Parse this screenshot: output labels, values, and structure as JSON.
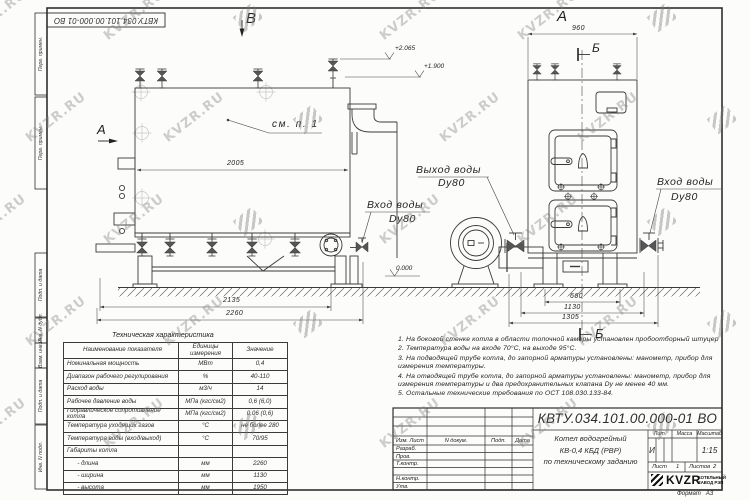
{
  "watermark": {
    "text": "KVZR.RU"
  },
  "frame": {
    "top_stamp": "КВТУ.034.101.00.000-01 ВО",
    "left_columns": [
      "Перв. примен.",
      "Перв. примен.",
      "Подп. и дата",
      "Инв. N дубл.",
      "Взам. инв. N",
      "Подп. и дата",
      "Инв. N подл."
    ],
    "format_note": "Формат   А3"
  },
  "drawing": {
    "view_b_label": "В",
    "view_a_arrow_label": "А",
    "view_a_title": "А",
    "section_b_top": "Б",
    "section_b_bottom": "Б",
    "see_note": "см. п. 1",
    "levels": {
      "top": "+2.065",
      "mid": "+1.900",
      "zero": "0.000"
    },
    "labels": {
      "outlet_title": "Выход воды",
      "outlet_size": "Dy80",
      "inlet_side_title": "Вход воды",
      "inlet_side_size": "Dy80",
      "inlet_front_title": "Вход воды",
      "inlet_front_size": "Dy80"
    },
    "dims_side": [
      "2005",
      "2135",
      "2260"
    ],
    "dims_front": [
      "960",
      "660",
      "1130",
      "1305"
    ]
  },
  "spec_table": {
    "title": "Техническая характеристика",
    "headers": [
      "Наименование показателя",
      "Единицы измерения",
      "Значение"
    ],
    "rows": [
      {
        "name": "Номинальная мощность",
        "unit": "МВт",
        "value": "0,4"
      },
      {
        "name": "Диапазон рабочего регулирования",
        "unit": "%",
        "value": "40-110"
      },
      {
        "name": "Расход воды",
        "unit": "м3/ч",
        "value": "14"
      },
      {
        "name": "Рабочее давление воды",
        "unit": "МПа (кгс/см2)",
        "value": "0,6 (6,0)"
      },
      {
        "name": "Гидравлическое сопротивление котла",
        "unit": "МПа (кгс/см2)",
        "value": "0,06 (0,6)"
      },
      {
        "name": "Температура уходящих газов",
        "unit": "°С",
        "value": "не более 280"
      },
      {
        "name": "Температура воды (вход/выход)",
        "unit": "°С",
        "value": "70/95"
      },
      {
        "name": "Габариты котла",
        "unit": "",
        "value": ""
      },
      {
        "name": "      - длина",
        "unit": "мм",
        "value": "2260"
      },
      {
        "name": "      - ширина",
        "unit": "мм",
        "value": "1130"
      },
      {
        "name": "      - высота",
        "unit": "мм",
        "value": "1950"
      }
    ]
  },
  "notes": [
    "1.  На боковой стенке котла в области топочной камеры установлен пробоотборный штуцер",
    "2.  Температура воды на входе  70°С,  на выходе  95°С.",
    "3.  На подводящей трубе котла, до запорной арматуры установлены:  манометр,  прибор для измерения температуры.",
    "4.  На отводящей трубе котла, до запорной арматуры установлены:  манометр,  прибор для измерения температуры и два предохранительных клапана   Dу не менее  40 мм.",
    "5.  Остальные технические требования по ОСТ  108.030.133-84."
  ],
  "title_block": {
    "doc_number": "КВТУ.034.101.00.000-01 ВО",
    "columns_header": [
      "Изм. Лист",
      "N докум.",
      "Подп.",
      "Дата"
    ],
    "sign_rows": [
      "Разраб.",
      "Пров.",
      "Т.контр.",
      "",
      "Н.контр.",
      "Утв."
    ],
    "product_title_lines": [
      "Котел водогрейный",
      "КВ-0,4  КБД  (РВР)",
      "по техническому заданию"
    ],
    "lit_label": "Лит.",
    "lit_value": "И",
    "mass_label": "Масса",
    "mass_value": "",
    "scale_label": "Масштаб",
    "scale_value": "1:15",
    "sheet_label": "Лист",
    "sheet_value": "1",
    "sheets_label": "Листов",
    "sheets_value": "2",
    "logo_text": "KVZR",
    "company_line1": "КОТЕЛЬНЫЙ",
    "company_line2": "ЗАВОД РЭП"
  }
}
